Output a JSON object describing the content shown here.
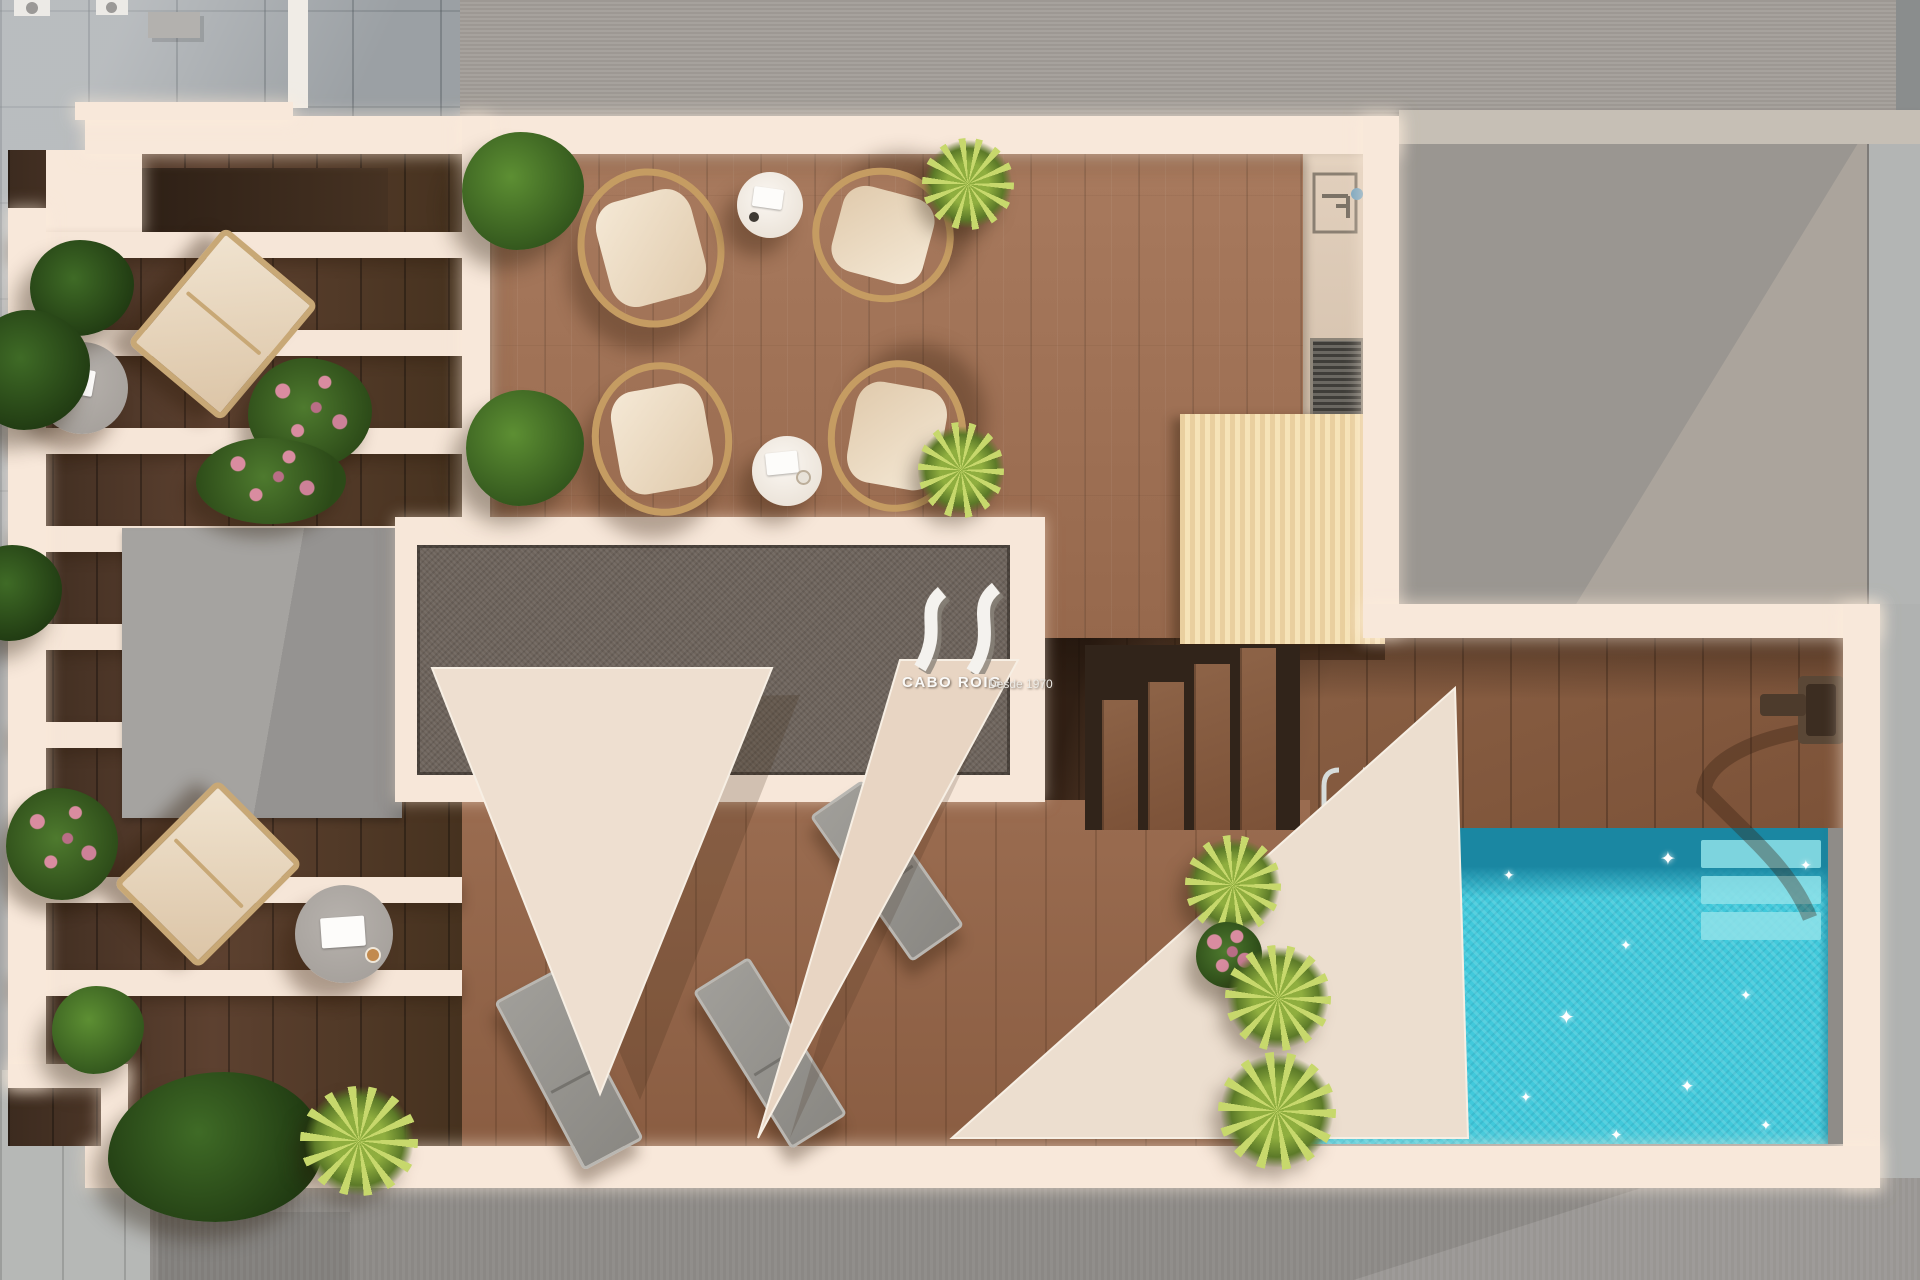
{
  "watermark": {
    "brand": "CABO ROIG",
    "tagline": "Desde 1970",
    "monogram_icon": "av-ribbon-monogram"
  },
  "palette": {
    "surround_gray": "#a19d99",
    "street_gray": "#8e8b88",
    "pavement_blue_gray": "#9ba0a4",
    "wall_cream": "#f8e8da",
    "deck_wood": "#a3765a",
    "dark_wood": "#4a3322",
    "gravel_roof": "#6e645c",
    "access_box_gray": "#9c9a96",
    "pergola_slats": "#f2d9ab",
    "pool_water": "#41c9db",
    "pool_shadow": "#1a87a2",
    "pool_step": "#8fe2e9",
    "sail_beige": "#eedfd0",
    "lounger_gray": "#918f8b",
    "wicker_tan": "#c59c62",
    "cushion_cream": "#f3e6d2",
    "plant_green": "#33571d",
    "palm_green": "#c7d86c"
  }
}
